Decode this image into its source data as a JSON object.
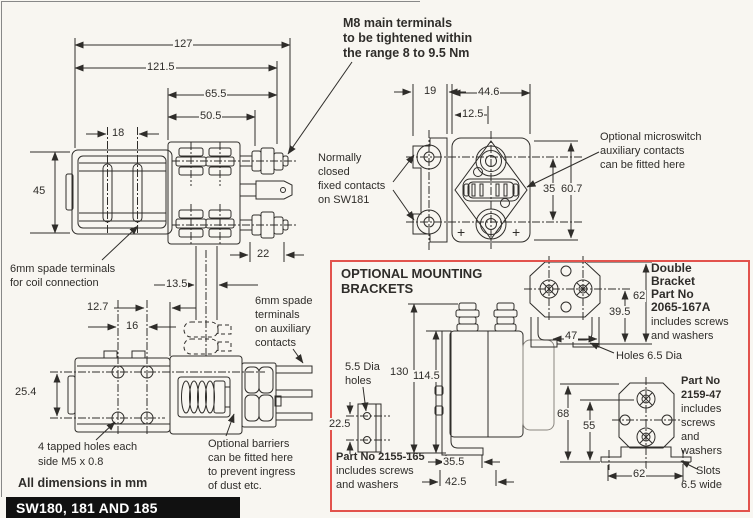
{
  "colors": {
    "bg": "#f8f6f1",
    "ink": "#2f2d2a",
    "red_border": "#e2534d",
    "banner_bg": "#111111",
    "banner_fg": "#ffffff"
  },
  "banner": {
    "title": "SW180, 181 AND 185",
    "note": "All dimensions in mm"
  },
  "notes": {
    "m8": [
      "M8 main terminals",
      "to be tightened within",
      "the range 8 to 9.5 Nm"
    ],
    "normally_closed": [
      "Normally",
      "closed",
      "fixed contacts",
      "on SW181"
    ],
    "microswitch": [
      "Optional microswitch",
      "auxiliary contacts",
      "can be fitted here"
    ],
    "coil_spade": [
      "6mm spade terminals",
      "for coil connection"
    ],
    "aux_spade": [
      "6mm spade",
      "terminals",
      "on auxiliary",
      "contacts"
    ],
    "tapped_holes": [
      "4 tapped holes each",
      "side M5 x 0.8"
    ],
    "barriers": [
      "Optional barriers",
      "can be fitted here",
      "to prevent ingress",
      "of dust etc."
    ]
  },
  "side_view_dims": {
    "overall": "127",
    "to_nut": "121.5",
    "block": "65.5",
    "to_stud": "50.5",
    "slot_pitch": "18",
    "height": "45",
    "nut": "22",
    "aux_offset": "13.5"
  },
  "end_view_dims": {
    "rear_width": "19",
    "body_width": "44.6",
    "terminal_offset": "12.5",
    "terminal_pitch": "35",
    "body_height": "60.7"
  },
  "top_view_dims": {
    "hole_offset": "12.7",
    "hole_pitch": "16",
    "row_pitch": "25.4"
  },
  "plus_mark": "+",
  "brackets_box": {
    "title": [
      "OPTIONAL MOUNTING",
      "BRACKETS"
    ],
    "flat_plate": {
      "holes_note": [
        "5.5 Dia",
        "holes"
      ],
      "height": "22.5",
      "part": [
        "Part No 2155-165",
        "includes screws",
        "and washers"
      ]
    },
    "assembly": {
      "overall_height": "130",
      "body_height": "114.5",
      "foot_depth": "35.5",
      "foot_width": "42.5"
    },
    "double_bracket": {
      "label": [
        "Double",
        "Bracket",
        "Part No",
        "2065-167A"
      ],
      "sublabel": [
        "includes screws",
        "and washers"
      ],
      "height": "62",
      "inner_height": "39.5",
      "width": "47",
      "holes_note": "Holes 6.5 Dia"
    },
    "single_bracket": {
      "label": [
        "Part No",
        "2159-47"
      ],
      "sublabel": [
        "includes",
        "screws",
        "and",
        "washers"
      ],
      "height": "68",
      "inner_height": "55",
      "width": "62",
      "slots_note": [
        "Slots",
        "6.5 wide"
      ]
    }
  }
}
